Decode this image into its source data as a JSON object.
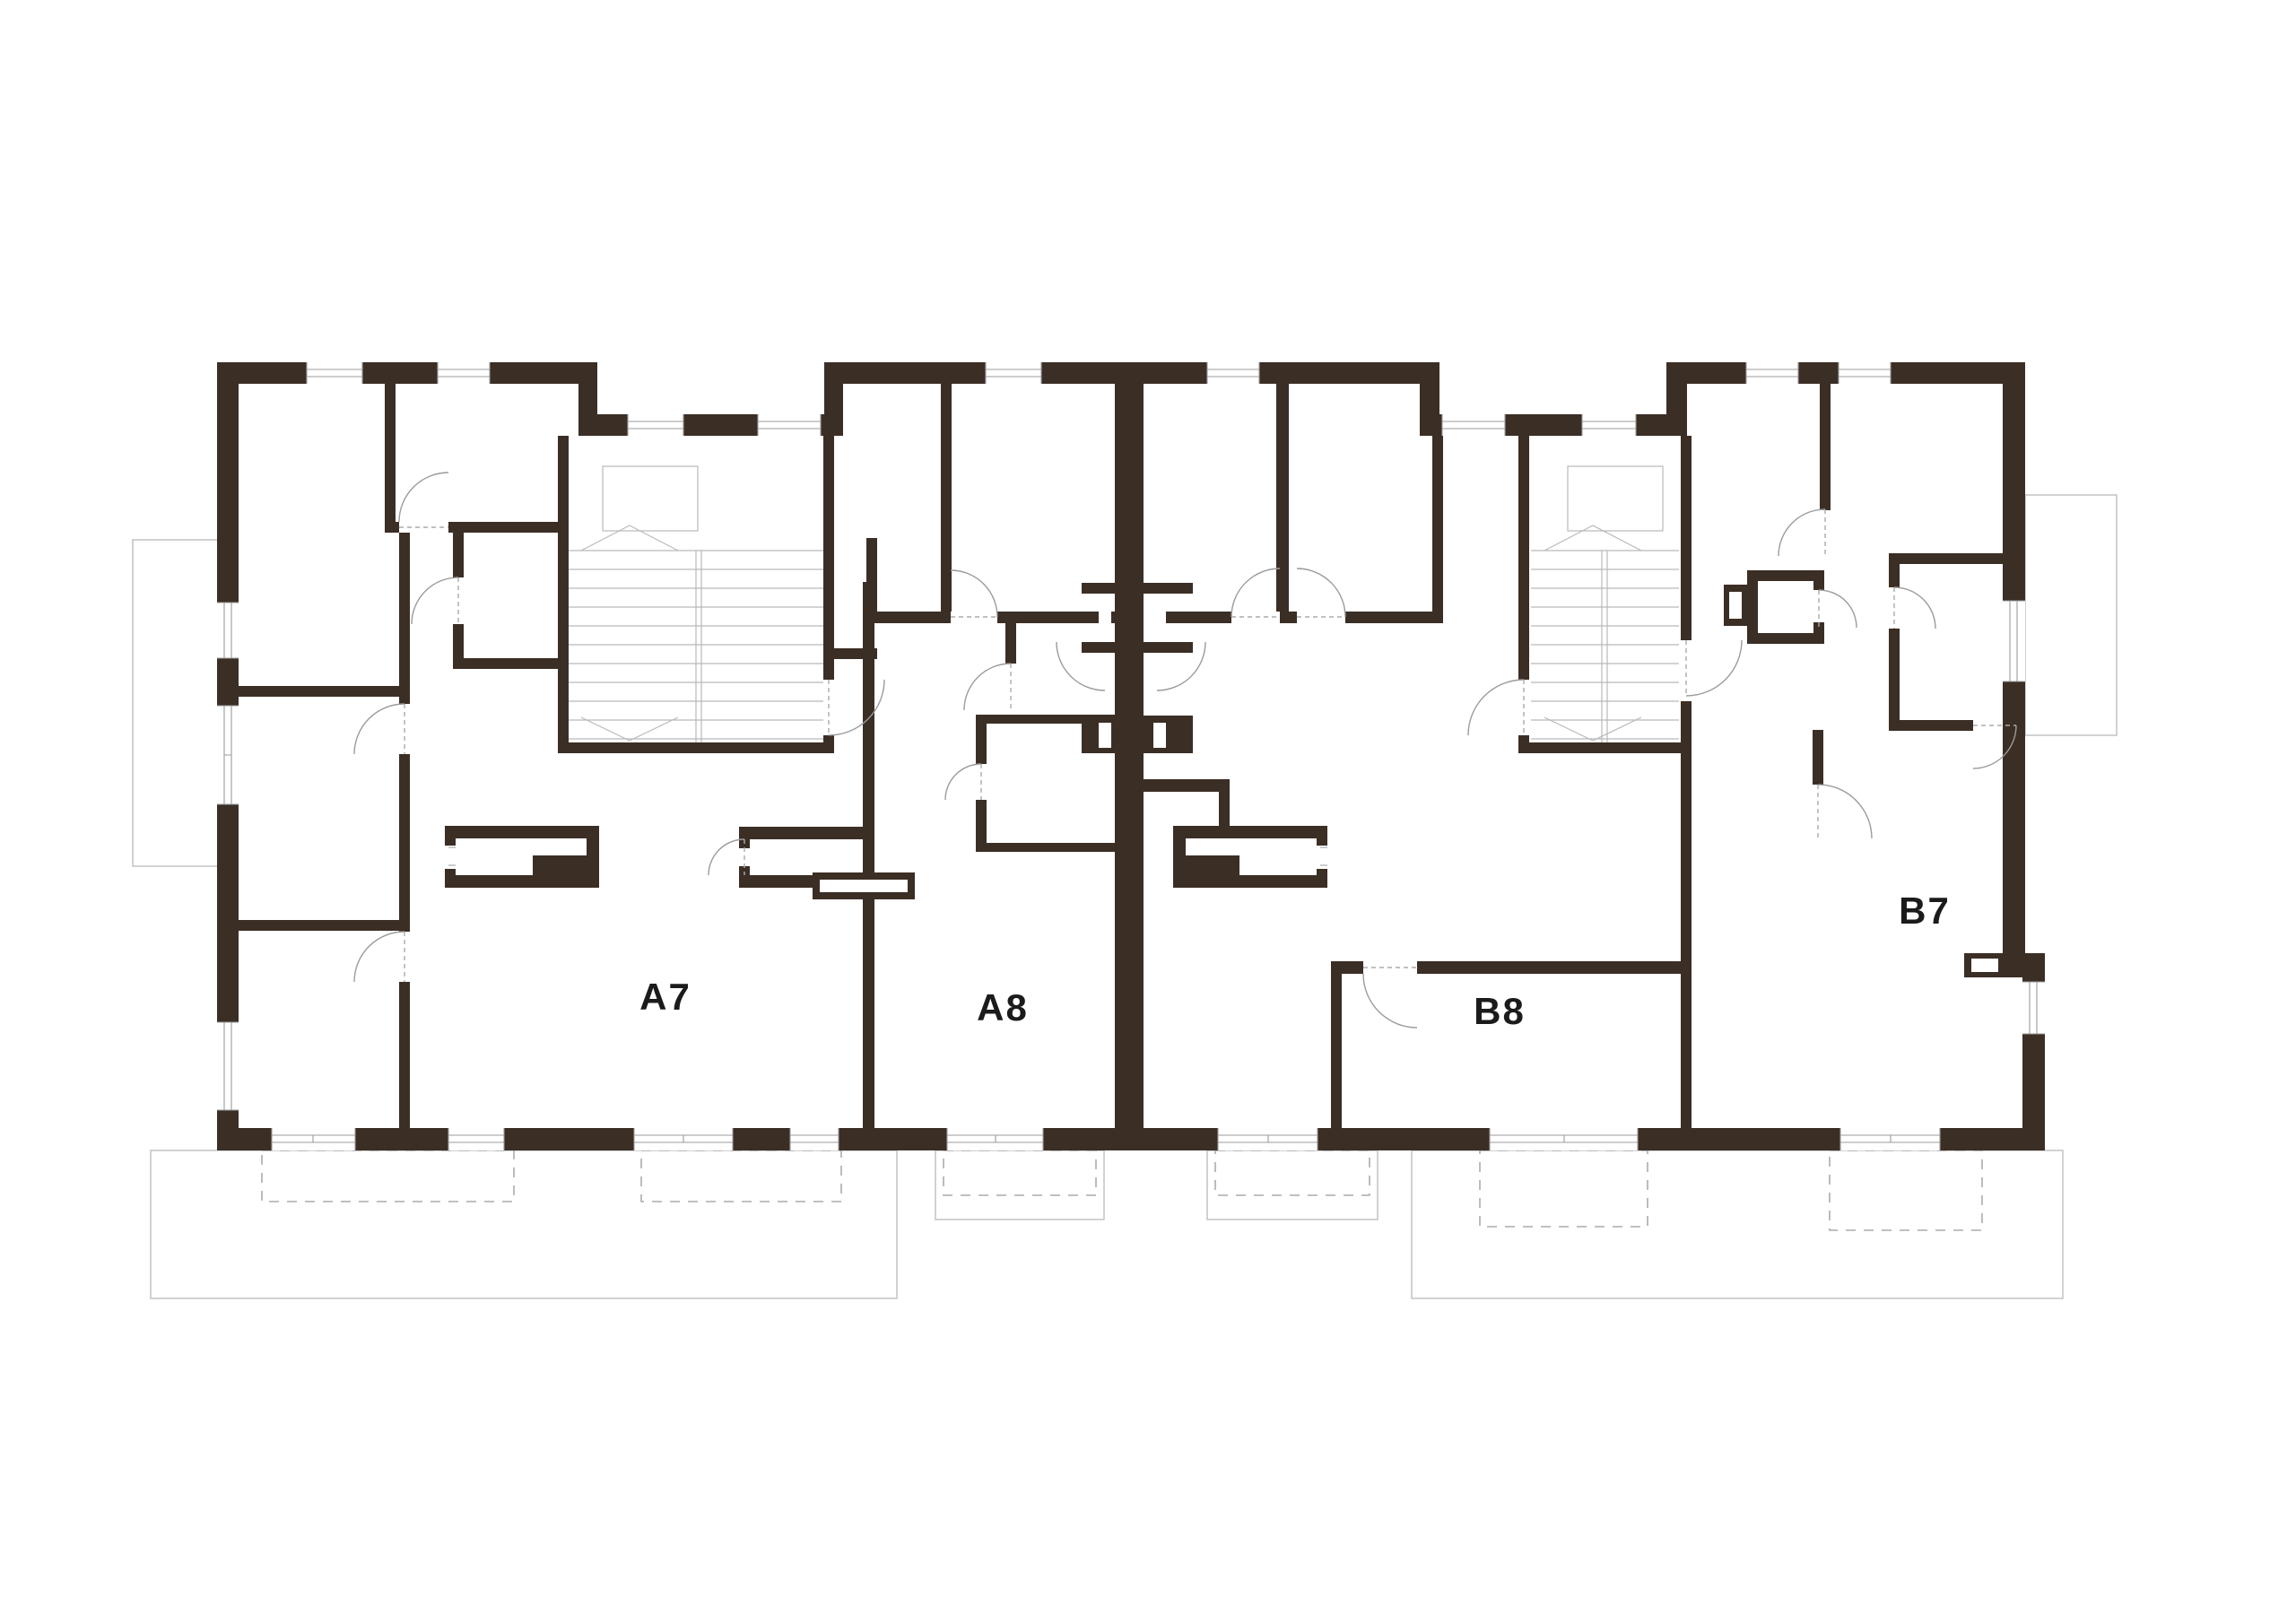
{
  "page": {
    "background": "#FFFFFF"
  },
  "floorplan": {
    "type": "architectural-floor-plan",
    "units": [
      {
        "id": "A7",
        "label": "A7"
      },
      {
        "id": "A8",
        "label": "A8"
      },
      {
        "id": "B8",
        "label": "B8"
      },
      {
        "id": "B7",
        "label": "B7"
      }
    ],
    "features": {
      "stairwell_count": 2,
      "balcony_sides": [
        "left",
        "right",
        "bottom"
      ]
    },
    "colors": {
      "wall": "#3B2E25",
      "thin": "#9B9B9B",
      "balc": "#C6C6C6",
      "dash": "#ABABAB",
      "labelc": "#1B1B1B",
      "bg": "#FFFFFF"
    }
  }
}
